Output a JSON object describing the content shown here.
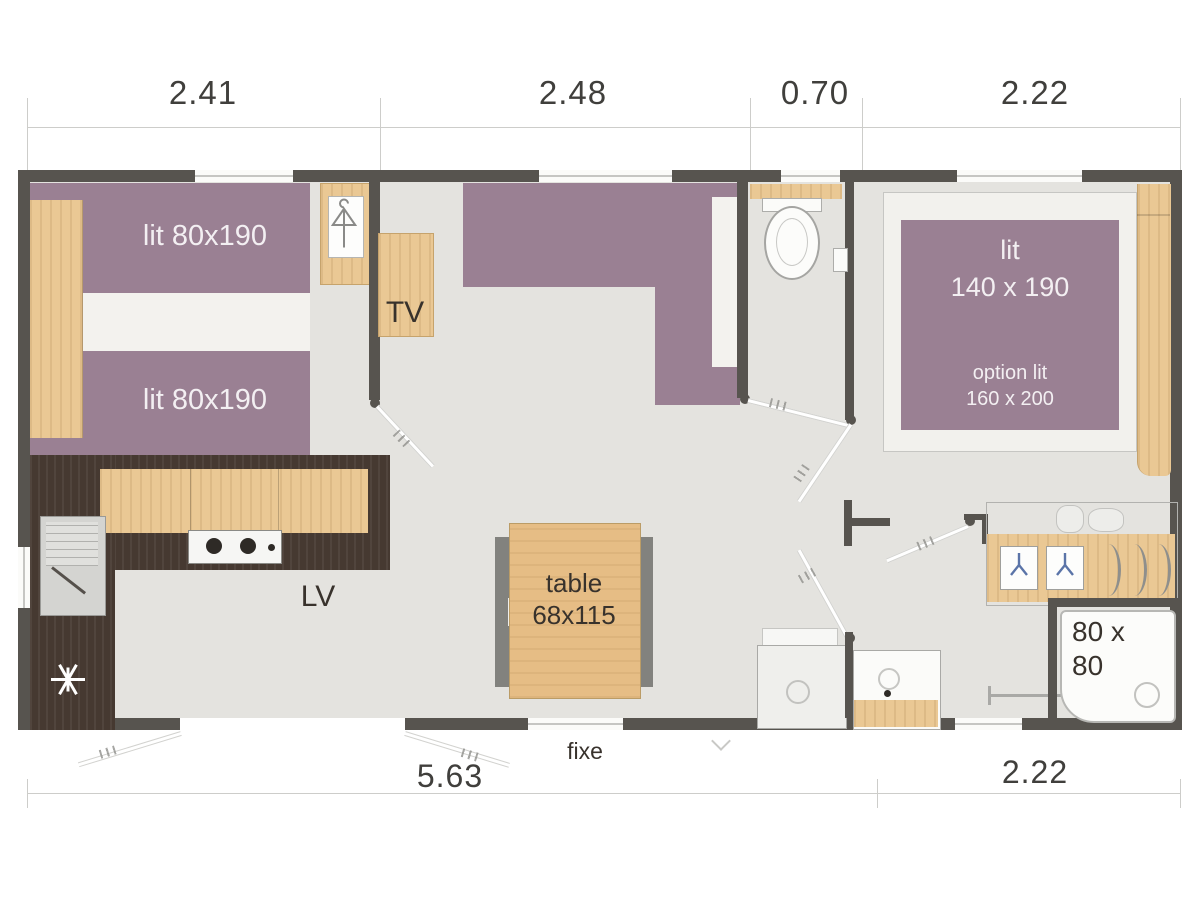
{
  "plan": {
    "top_dimensions": [
      {
        "label": "2.41"
      },
      {
        "label": "2.48"
      },
      {
        "label": "0.70"
      },
      {
        "label": "2.22"
      }
    ],
    "bottom_dimensions": {
      "left": "5.63",
      "right": "2.22"
    },
    "window_fixed_label": "fixe",
    "bedroom_left": {
      "bed_top": "lit 80x190",
      "bed_bottom": "lit 80x190"
    },
    "living": {
      "tv_label": "TV"
    },
    "kitchen": {
      "dishwasher_label": "LV"
    },
    "dining": {
      "table_label_line1": "table",
      "table_label_line2": "68x115"
    },
    "bedroom_right": {
      "bed_label_line1": "lit",
      "bed_label_line2": "140 x 190",
      "bed_option_line1": "option lit",
      "bed_option_line2": "160 x 200"
    },
    "bathroom": {
      "shower_label_line1": "80 x",
      "shower_label_line2": "80"
    },
    "colors": {
      "wall": "#57544f",
      "floor": "#e4e3df",
      "bed_purple": "#9a8093",
      "wood": "#eac894",
      "kitchen_dark": "#463931",
      "accent_blue": "#5b74a8"
    }
  }
}
